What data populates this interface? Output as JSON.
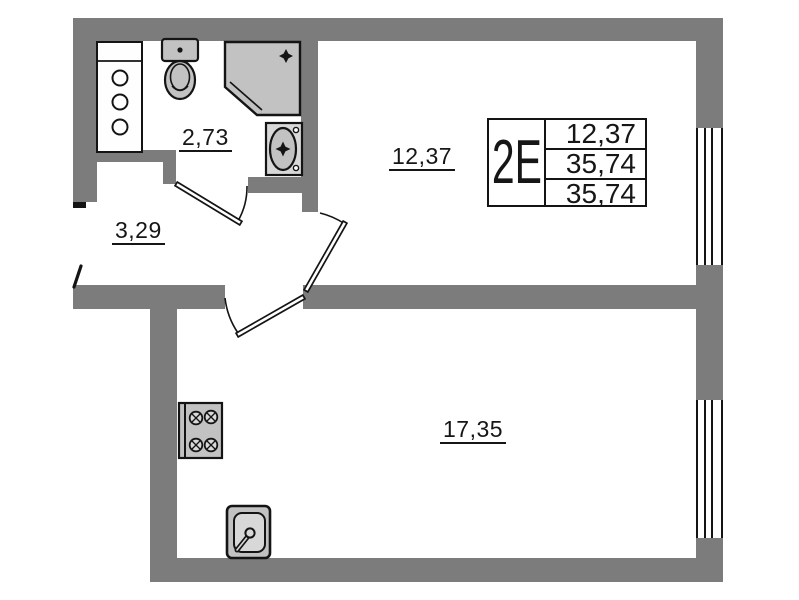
{
  "plan": {
    "info_box": {
      "unit_type": "2E",
      "values": [
        "12,37",
        "35,74",
        "35,74"
      ]
    },
    "room_areas": {
      "bathroom": "2,73",
      "hallway": "3,29",
      "bedroom": "12,37",
      "living_kitchen": "17,35"
    },
    "colors": {
      "wall": "#7c7c7c",
      "line": "#141414",
      "fixture_fill": "#c2c2c2",
      "fixture_fill_light": "#d8d8d8",
      "cabinet_fill": "#fefefe",
      "background": "#ffffff"
    },
    "fixtures": {
      "bathroom": [
        "cabinet-icon",
        "toilet-icon",
        "shower-cabin-icon",
        "wash-basin-icon"
      ],
      "kitchen": [
        "stove-icon",
        "kitchen-sink-icon"
      ]
    }
  }
}
